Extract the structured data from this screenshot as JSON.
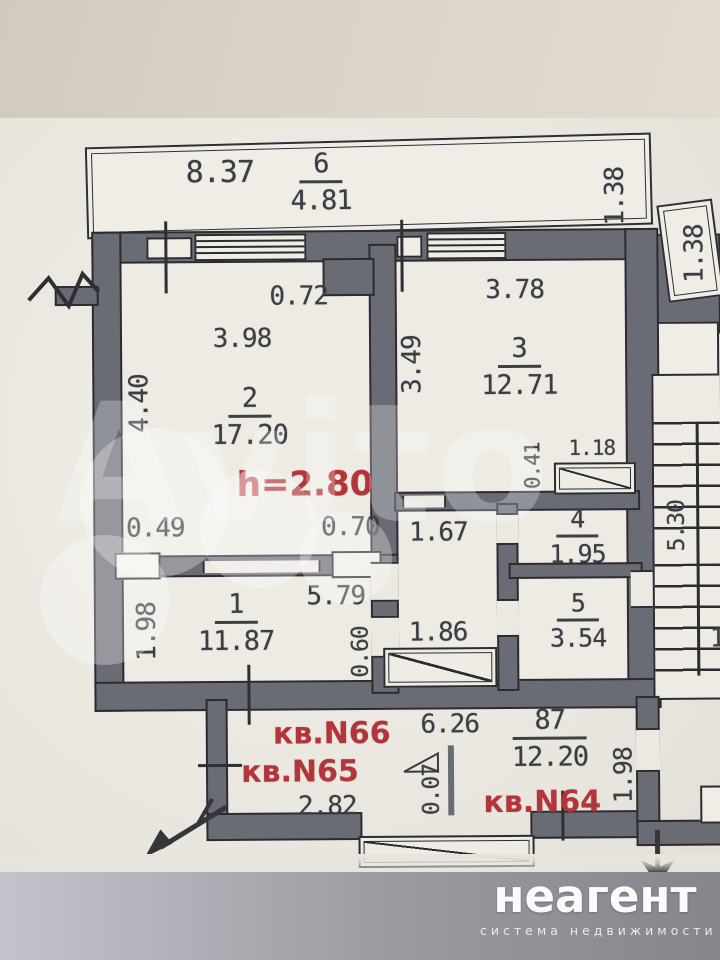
{
  "colors": {
    "wall": "#696c75",
    "line": "#2b2b30",
    "red_accent": "#b23639",
    "paper": "#ece9e2"
  },
  "watermark": {
    "text": "Avito"
  },
  "logo": {
    "brand": "неагент",
    "tagline": "система недвижимости"
  },
  "plan": {
    "ceiling_height": "h=2.80",
    "balcony": {
      "length": "8.37",
      "num": "6",
      "area": "4.81",
      "depth": "1.38"
    },
    "side_balcony": {
      "depth": "1.38"
    },
    "room2": {
      "num": "2",
      "area": "17.20",
      "width": "3.98",
      "depth": "4.40",
      "duct": "0.72",
      "pier_left": "0.49",
      "pier_right": "0.70"
    },
    "room3": {
      "num": "3",
      "area": "12.71",
      "width": "3.78",
      "depth": "3.49",
      "shaft_width": "1.18",
      "shaft_depth": "0.41"
    },
    "room4": {
      "num": "4",
      "area": "1.95"
    },
    "room5": {
      "num": "5",
      "area": "3.54"
    },
    "room1": {
      "num": "1",
      "area": "11.87",
      "width": "5.79",
      "depth": "1.98"
    },
    "corridor": {
      "w1": "1.67",
      "w2": "1.86",
      "d": "0.60"
    },
    "stairs": {
      "length": "5.30",
      "edge": "1"
    },
    "flats": {
      "n66": "кв.N66",
      "n65": "кв.N65",
      "n64": "кв.N64",
      "dim": "6.26",
      "num": "87",
      "area": "12.20",
      "width": "2.82",
      "thin": "0.07",
      "depth": "1.98"
    }
  }
}
